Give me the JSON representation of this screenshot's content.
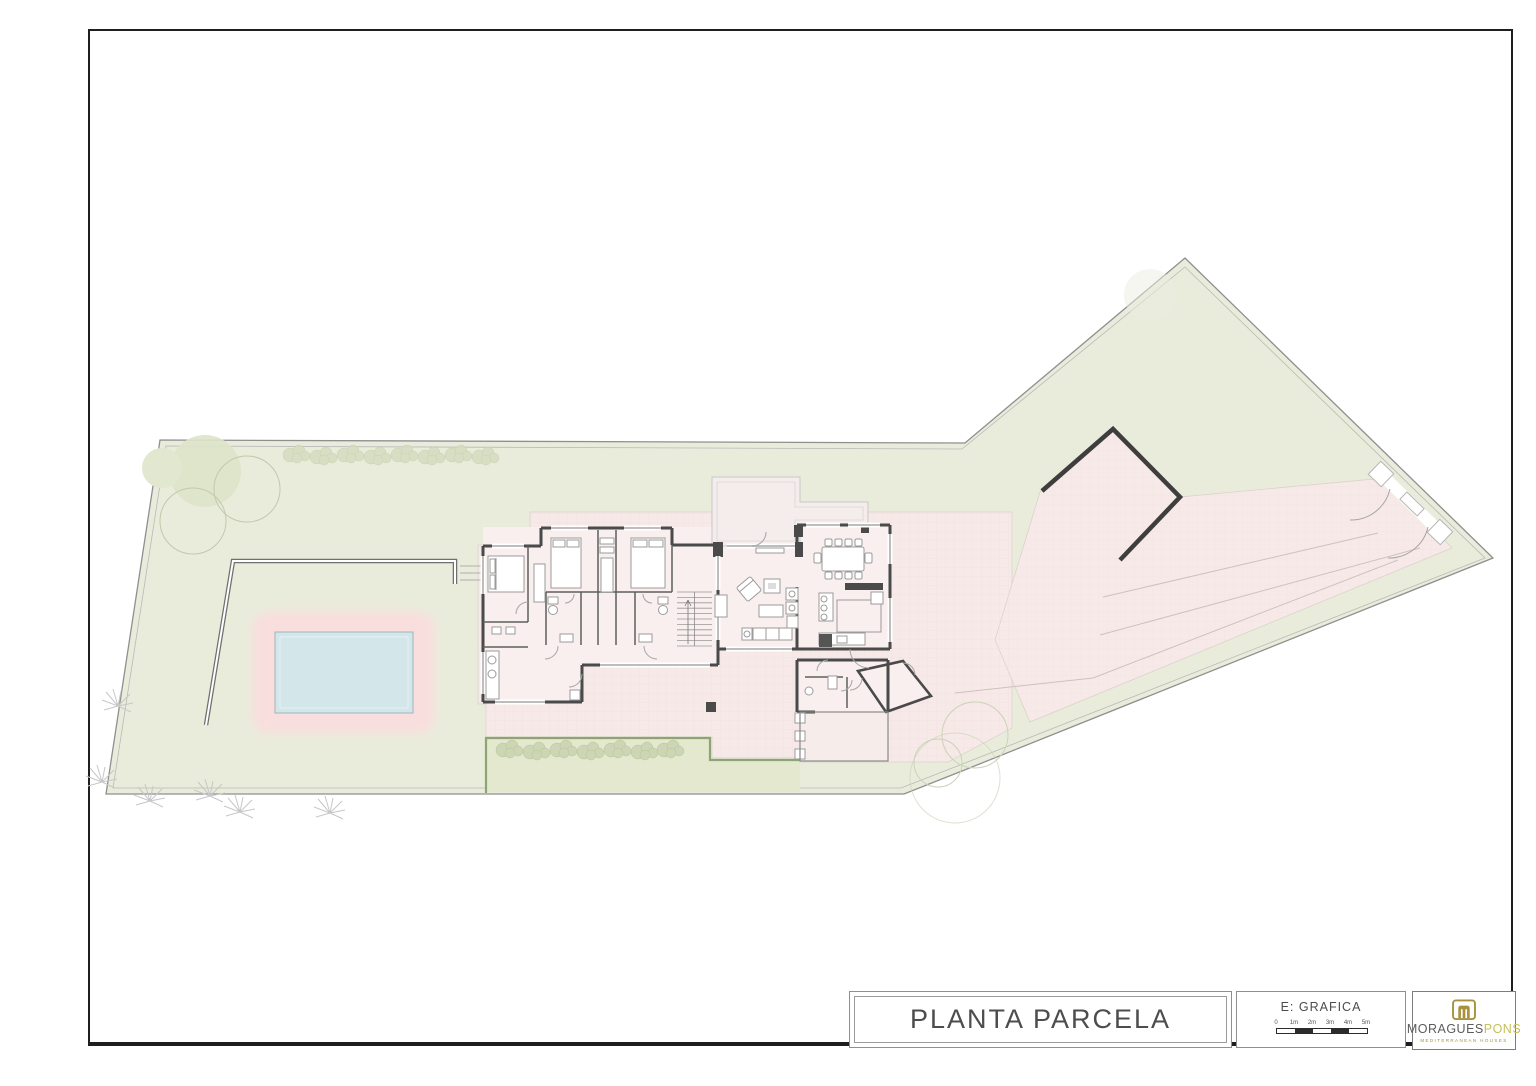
{
  "title_block": {
    "title": "PLANTA PARCELA",
    "scale": {
      "label": "E: GRAFICA",
      "ticks": [
        "0",
        "1m",
        "2m",
        "3m",
        "4m",
        "5m"
      ]
    },
    "logo": {
      "brand_primary": "MORAGUES",
      "brand_secondary": "PONS",
      "tagline": "MEDITERRANEAN HOUSES",
      "gold": "#a8923e"
    }
  },
  "plan": {
    "name": "site plan - planta parcela",
    "colors": {
      "parcel": "#e9ecdb",
      "parcel_line": "#8f8f8f",
      "terrace": "#f6e9e7",
      "floor": "#f8efee",
      "patio": "#f5ecec",
      "pool": "#d3e6e9",
      "pool_deck": "#f9dede",
      "hedge": "#8da573",
      "hedge_fill": "#e3e8cf",
      "bush": "#d6dcc0",
      "wall": "#4a4a4a",
      "wall_interior": "#5f5f5f",
      "window": "#bdbdbd",
      "furniture": "#9b9b9b",
      "drive_line": "#cfc0c0"
    }
  }
}
